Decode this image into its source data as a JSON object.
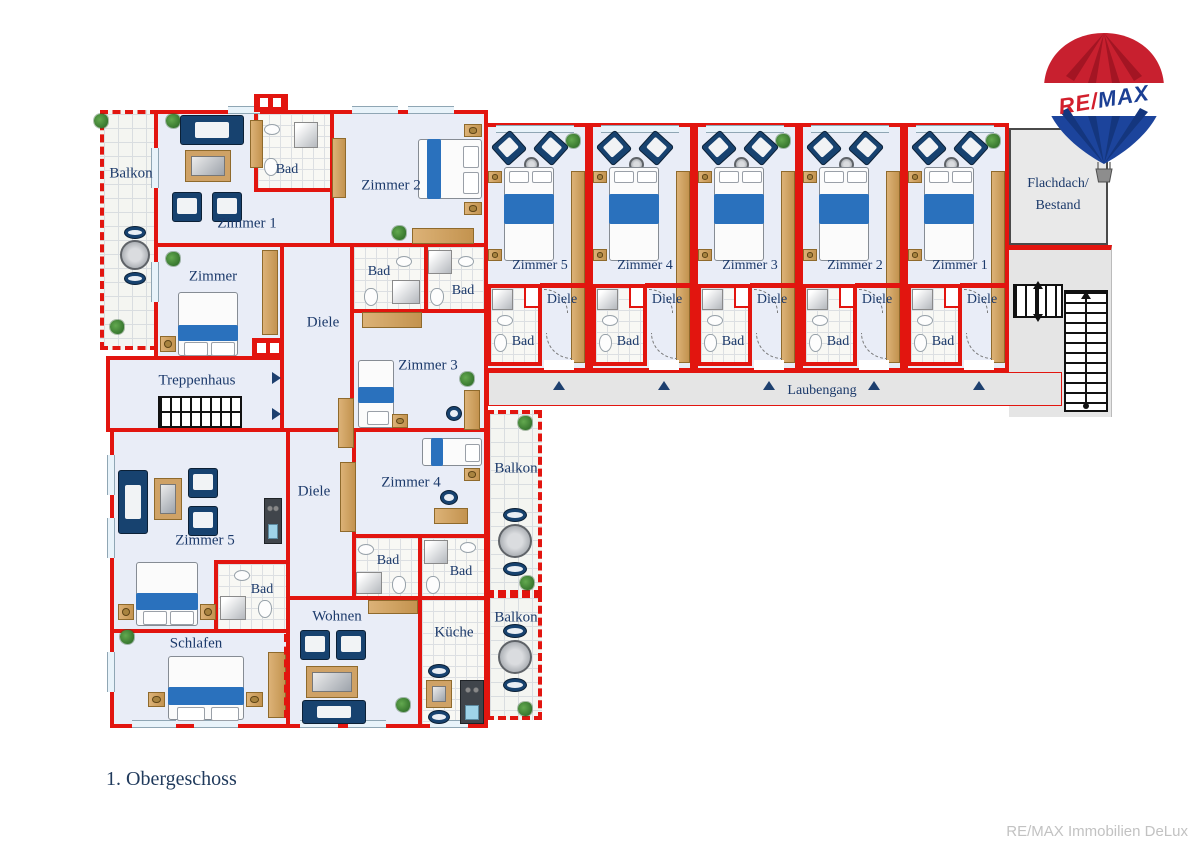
{
  "title": "1. Obergeschoss",
  "footer": "RE/MAX Immobilien DeLux",
  "logo": {
    "re": "RE/",
    "max": "MAX"
  },
  "left_wing": {
    "balkon_left": "Balkon",
    "zimmer1": "Zimmer 1",
    "bad_top": "Bad",
    "zimmer2": "Zimmer 2",
    "zimmer": "Zimmer",
    "diele_top": "Diele",
    "bad_mid_left": "Bad",
    "bad_mid_right": "Bad",
    "zimmer3": "Zimmer 3",
    "treppenhaus": "Treppenhaus",
    "zimmer5": "Zimmer 5",
    "diele_bottom": "Diele",
    "zimmer4": "Zimmer 4",
    "bad_zimmer5": "Bad",
    "bad_zimmer4_left": "Bad",
    "bad_zimmer4_right": "Bad",
    "balkon_top": "Balkon",
    "schlafen": "Schlafen",
    "wohnen": "Wohnen",
    "kueche": "Küche",
    "balkon_bottom": "Balkon"
  },
  "right_wing": {
    "units": [
      {
        "room": "Zimmer 5",
        "hall": "Diele",
        "bath": "Bad"
      },
      {
        "room": "Zimmer 4",
        "hall": "Diele",
        "bath": "Bad"
      },
      {
        "room": "Zimmer 3",
        "hall": "Diele",
        "bath": "Bad"
      },
      {
        "room": "Zimmer 2",
        "hall": "Diele",
        "bath": "Bad"
      },
      {
        "room": "Zimmer 1",
        "hall": "Diele",
        "bath": "Bad"
      }
    ],
    "laubengang": "Laubengang",
    "flachdach_line1": "Flachdach/",
    "flachdach_line2": "Bestand"
  },
  "colors": {
    "wall_red": "#e2150f",
    "label_navy": "#1c3a6b",
    "logo_red": "#d21f2c",
    "logo_blue": "#1b3f94",
    "furniture_navy": "#17426f",
    "blanket_blue": "#2a71bd",
    "wood": "#cfa266",
    "footer_gray": "#c2c2c2"
  }
}
